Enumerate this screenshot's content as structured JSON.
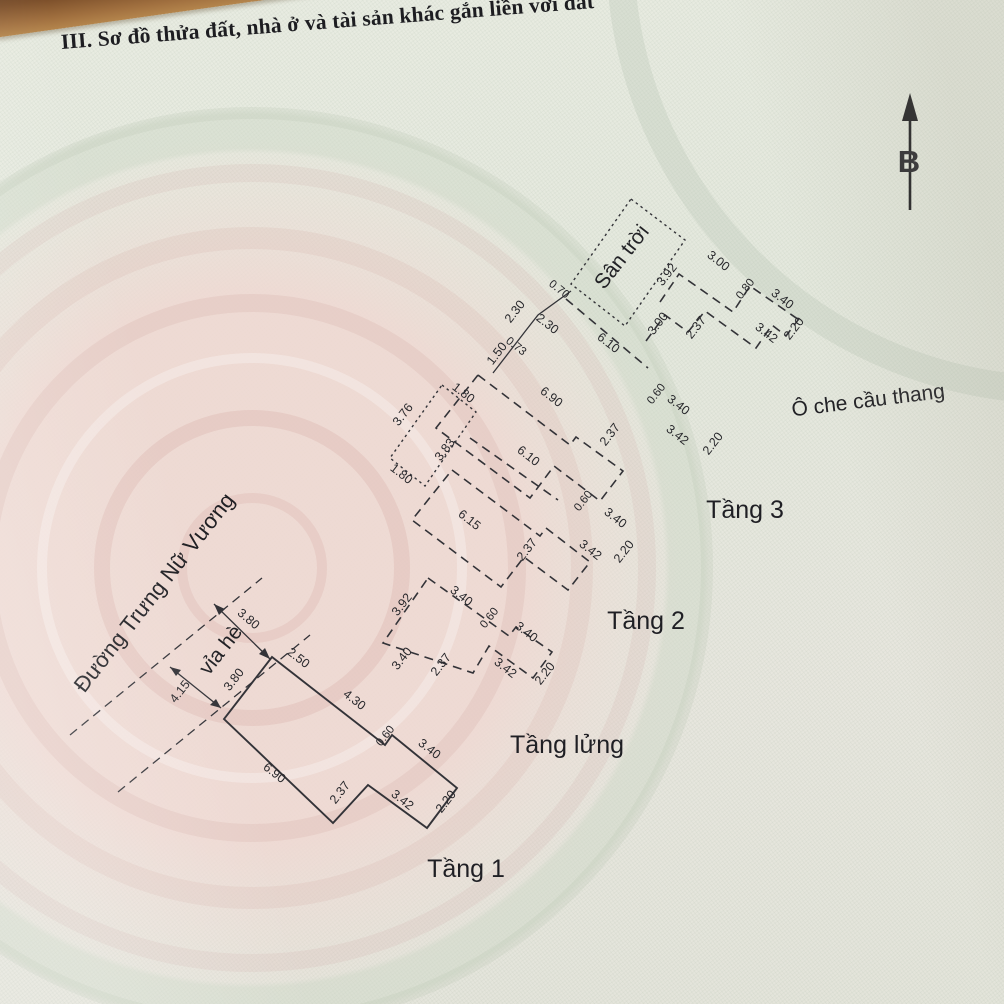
{
  "title": "III. Sơ đồ thửa đất, nhà ở và tài sản khác gắn liền với đất",
  "compass": {
    "north_label": "B"
  },
  "street": {
    "name": "Đường Trưng Nữ Vương",
    "sidewalk": "vỉa hè",
    "road_width": "4.15"
  },
  "roof": {
    "sky_yard_label": "Sân trời",
    "stair_cover_label": "Ô che cầu thang",
    "cluster": [
      "1.50",
      "0.73",
      "2.30",
      "2.30",
      "0.70"
    ],
    "long_edge": "6.10",
    "top_chain": [
      "3.92",
      "3.00",
      "0.80",
      "3.40"
    ],
    "bottom_chain": [
      "3.00",
      "2.37",
      "3.42",
      "2.20"
    ]
  },
  "tang3": {
    "label": "Tầng 3",
    "top_edge": "6.90",
    "inner_edge": "6.10",
    "notch": [
      "0.60",
      "3.40"
    ],
    "bottom_chain": [
      "2.37",
      "3.42",
      "2.20"
    ],
    "void": {
      "top": "1.80",
      "left": "3.76",
      "bottom": "1.80",
      "inner": "3.83"
    }
  },
  "tang2": {
    "label": "Tầng 2",
    "bottom_edge": "6.15",
    "notch": [
      "0.60",
      "3.40"
    ],
    "bottom_chain": [
      "2.37",
      "3.42",
      "2.20"
    ]
  },
  "tanglung": {
    "label": "Tầng lửng",
    "top_chain": [
      "3.92",
      "3.40",
      "0.60",
      "3.40"
    ],
    "left_edge": "3.40",
    "right_edge": "2.20",
    "bottom_chain": [
      "2.37",
      "3.42"
    ]
  },
  "tang1": {
    "label": "Tầng 1",
    "frontage": "3.80",
    "front_edge": "3.80",
    "top_chain": [
      "2.50",
      "4.30",
      "0.60",
      "3.40"
    ],
    "right_edge": "2.20",
    "bottom_chain": [
      "3.42",
      "2.37",
      "6.90"
    ]
  }
}
